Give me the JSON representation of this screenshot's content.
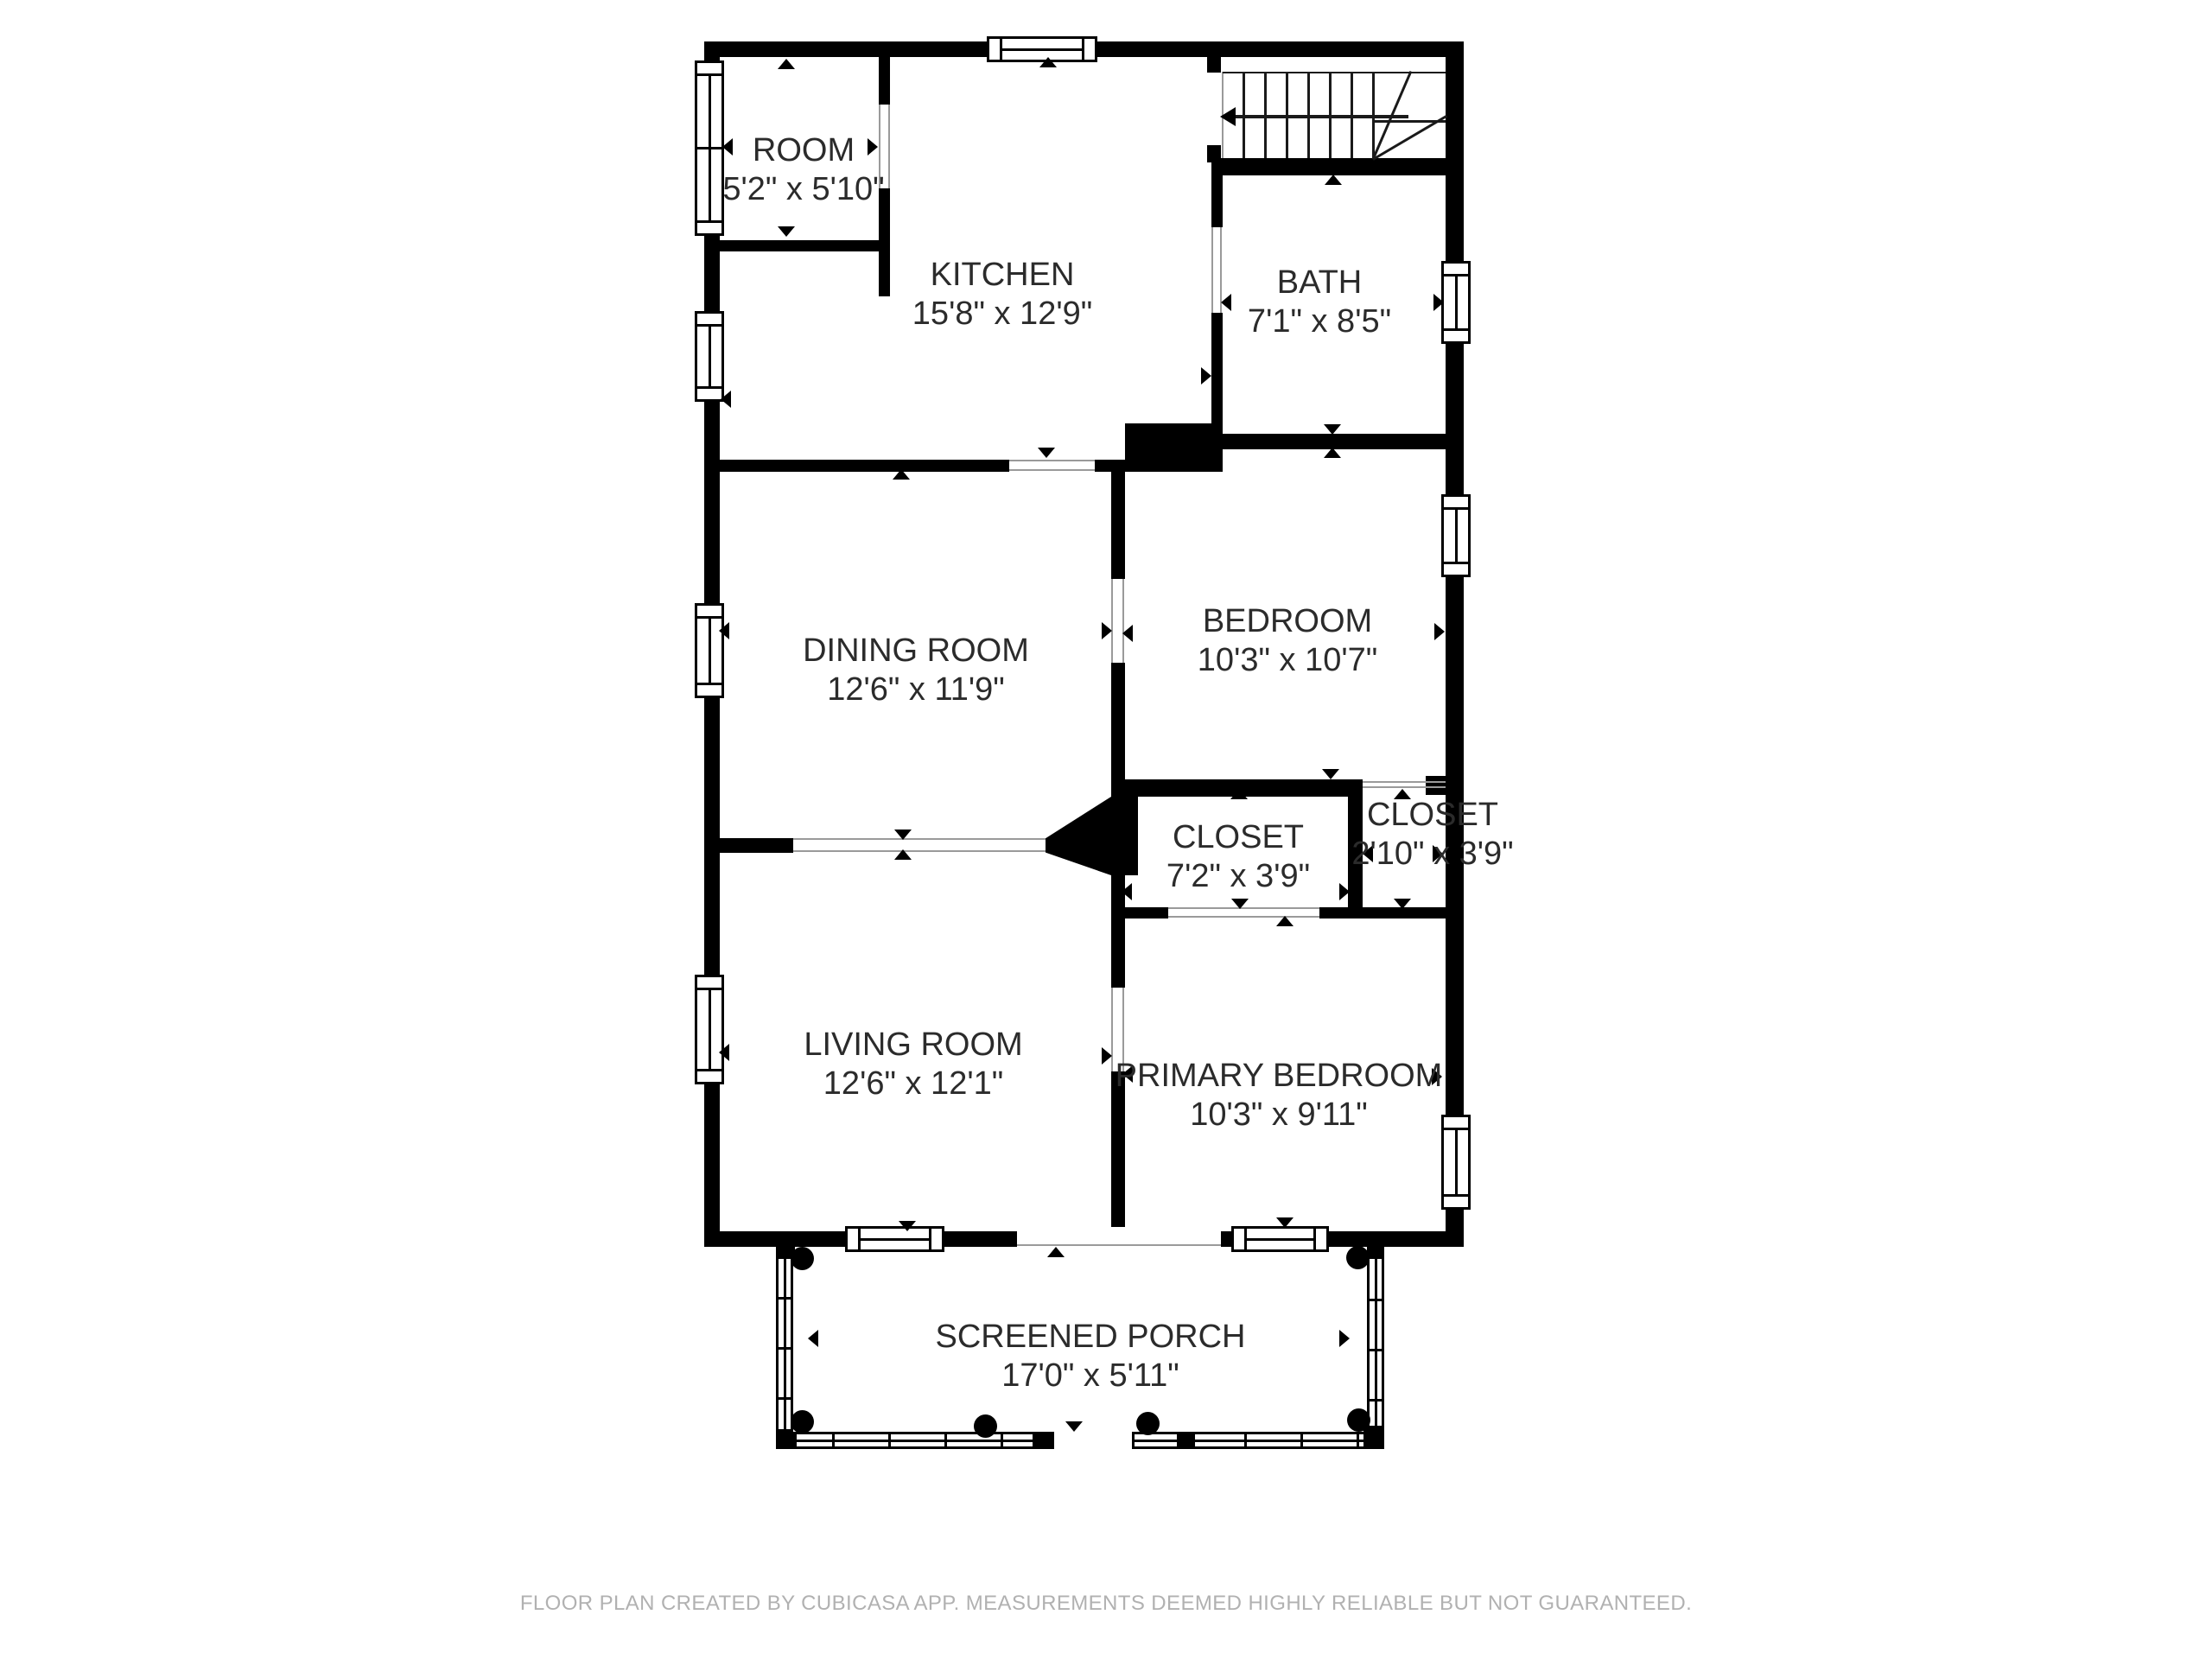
{
  "floorplan": {
    "rooms": [
      {
        "id": "room",
        "name": "ROOM",
        "dims": "5'2\" x 5'10\""
      },
      {
        "id": "kitchen",
        "name": "KITCHEN",
        "dims": "15'8\" x 12'9\""
      },
      {
        "id": "bath",
        "name": "BATH",
        "dims": "7'1\" x 8'5\""
      },
      {
        "id": "dining",
        "name": "DINING ROOM",
        "dims": "12'6\" x 11'9\""
      },
      {
        "id": "bedroom",
        "name": "BEDROOM",
        "dims": "10'3\" x 10'7\""
      },
      {
        "id": "closet1",
        "name": "CLOSET",
        "dims": "7'2\" x 3'9\""
      },
      {
        "id": "closet2",
        "name": "CLOSET",
        "dims": "2'10\" x 3'9\""
      },
      {
        "id": "living",
        "name": "LIVING ROOM",
        "dims": "12'6\" x 12'1\""
      },
      {
        "id": "primary",
        "name": "PRIMARY BEDROOM",
        "dims": "10'3\" x 9'11\""
      },
      {
        "id": "porch",
        "name": "SCREENED PORCH",
        "dims": "17'0\" x 5'11\""
      }
    ],
    "footer": "FLOOR PLAN CREATED BY CUBICASA APP. MEASUREMENTS DEEMED HIGHLY RELIABLE BUT NOT GUARANTEED.",
    "colors": {
      "wall": "#000000",
      "background": "#ffffff",
      "label": "#2b2b2b",
      "footer": "#b1b1b1"
    }
  }
}
